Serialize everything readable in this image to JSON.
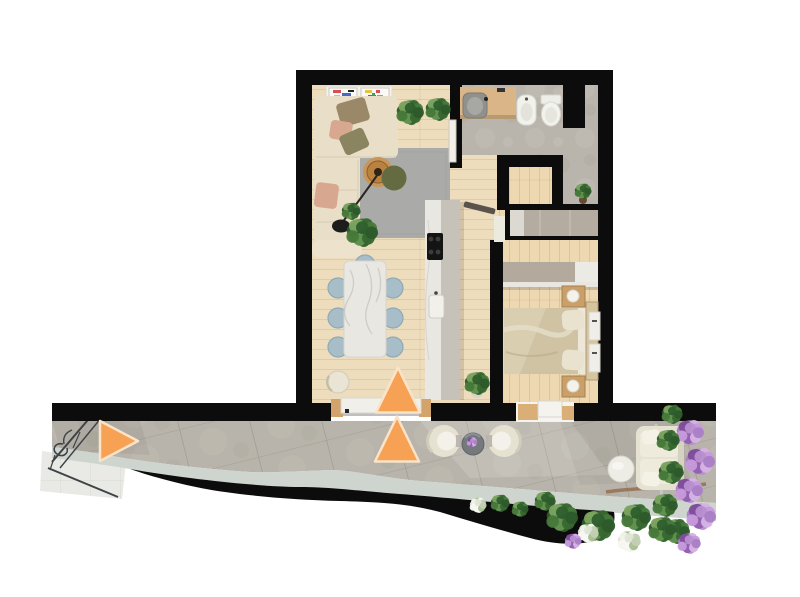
{
  "scene": {
    "type": "floor-plan-3d-top-view",
    "subject": "one-bedroom-apartment-with-terrace",
    "colors": {
      "background": "#ffffff",
      "wall": "#0c0c0c",
      "wood_living": "#eeddbc",
      "wood_bedroom": "#eed8b2",
      "concrete": "#bab5ac",
      "terrace_tile": "#b8b4ab",
      "curb": "#ced4ce",
      "light_tiles": "#e9eae5",
      "rug": "#aaaaa8",
      "sofa": "#e9dfc9",
      "marble": "#e9e7e2",
      "counter_top": "#c7c2b9",
      "chair_blue": "#a7bdc8",
      "bed_duvet": "#cfc3a4",
      "wardrobe": "#b4aca0",
      "wood_accent": "#d9ae77",
      "white_furniture": "#edece5",
      "outdoor_cream": "#e6e2d2",
      "railing": "#3f4246",
      "soil": "#8a5a36"
    },
    "rooms": [
      {
        "name": "living-room",
        "floor": "wood"
      },
      {
        "name": "dining-area",
        "floor": "wood"
      },
      {
        "name": "kitchen",
        "floor": "wood"
      },
      {
        "name": "bathroom",
        "floor": "concrete"
      },
      {
        "name": "hallway",
        "floor": "wood"
      },
      {
        "name": "bedroom",
        "floor": "wood"
      },
      {
        "name": "terrace",
        "floor": "stone-tiles"
      }
    ],
    "furniture": {
      "living_room": [
        "l-shaped-sofa",
        "throw-pillows",
        "arc-floor-lamp",
        "rattan-coffee-table",
        "olive-pouf",
        "grey-rug",
        "art-frames",
        "potted-plants",
        "wall-mounted-panels"
      ],
      "dining_area": [
        "marble-dining-table",
        "blue-side-chairs",
        "cream-end-chair"
      ],
      "kitchen": [
        "island-counter",
        "cooktop",
        "sink"
      ],
      "bathroom": [
        "vanity-with-sink",
        "bidet",
        "toilet"
      ],
      "bedroom": [
        "double-bed",
        "headboard",
        "nightstands",
        "table-lamps",
        "built-in-wardrobe",
        "console-shelf",
        "wall-panels"
      ],
      "terrace": [
        "window-bench",
        "lounge-armchairs",
        "flower-side-table",
        "outdoor-sofa",
        "round-coffee-table",
        "decorative-railing",
        "planting-beds"
      ]
    },
    "markers": {
      "color": "#f7a155",
      "border": "#fbe3c8",
      "items": [
        {
          "name": "terrace-view-arrow",
          "direction": "right",
          "cx": 119,
          "cy": 441,
          "w": 38,
          "h": 40
        },
        {
          "name": "entrance-view-arrow-upper",
          "direction": "up",
          "cx": 398,
          "cy": 390,
          "w": 44,
          "h": 45
        },
        {
          "name": "entrance-view-arrow-lower",
          "direction": "up",
          "cx": 397,
          "cy": 439,
          "w": 44,
          "h": 45
        }
      ]
    },
    "palettes": {
      "green": [
        "#2d5a2b",
        "#47793a",
        "#639350",
        "#38682f",
        "#7ba45f",
        "#2f5f2e"
      ],
      "purple": [
        "#a97fc6",
        "#c69bdb",
        "#9160ae",
        "#d5b4e4",
        "#7e4d9b",
        "#b88fd0"
      ],
      "white": [
        "#f1f3ec",
        "#dfe5d6",
        "#c2cfb2",
        "#f7f8f3",
        "#a9bd90"
      ]
    },
    "foliage": [
      [
        410,
        112,
        13,
        "green"
      ],
      [
        438,
        109,
        12,
        "green"
      ],
      [
        351,
        211,
        9,
        "green"
      ],
      [
        362,
        232,
        15,
        "green"
      ],
      [
        477,
        383,
        12,
        "green"
      ],
      [
        583,
        191,
        8,
        "green"
      ],
      [
        672,
        414,
        10,
        "green"
      ],
      [
        690,
        432,
        13,
        "purple"
      ],
      [
        668,
        440,
        11,
        "green"
      ],
      [
        700,
        461,
        14,
        "purple"
      ],
      [
        671,
        472,
        12,
        "green"
      ],
      [
        689,
        490,
        13,
        "purple"
      ],
      [
        665,
        505,
        12,
        "green"
      ],
      [
        701,
        516,
        14,
        "purple"
      ],
      [
        676,
        531,
        13,
        "green"
      ],
      [
        689,
        543,
        11,
        "purple"
      ],
      [
        545,
        501,
        10,
        "green"
      ],
      [
        562,
        517,
        15,
        "green"
      ],
      [
        598,
        525,
        16,
        "green"
      ],
      [
        636,
        517,
        14,
        "green"
      ],
      [
        662,
        529,
        13,
        "green"
      ],
      [
        588,
        533,
        10,
        "white"
      ],
      [
        629,
        541,
        11,
        "white"
      ],
      [
        478,
        505,
        8,
        "white"
      ],
      [
        500,
        503,
        9,
        "green"
      ],
      [
        520,
        509,
        8,
        "green"
      ],
      [
        573,
        541,
        8,
        "purple"
      ],
      [
        472,
        442,
        5,
        "purple"
      ]
    ]
  }
}
